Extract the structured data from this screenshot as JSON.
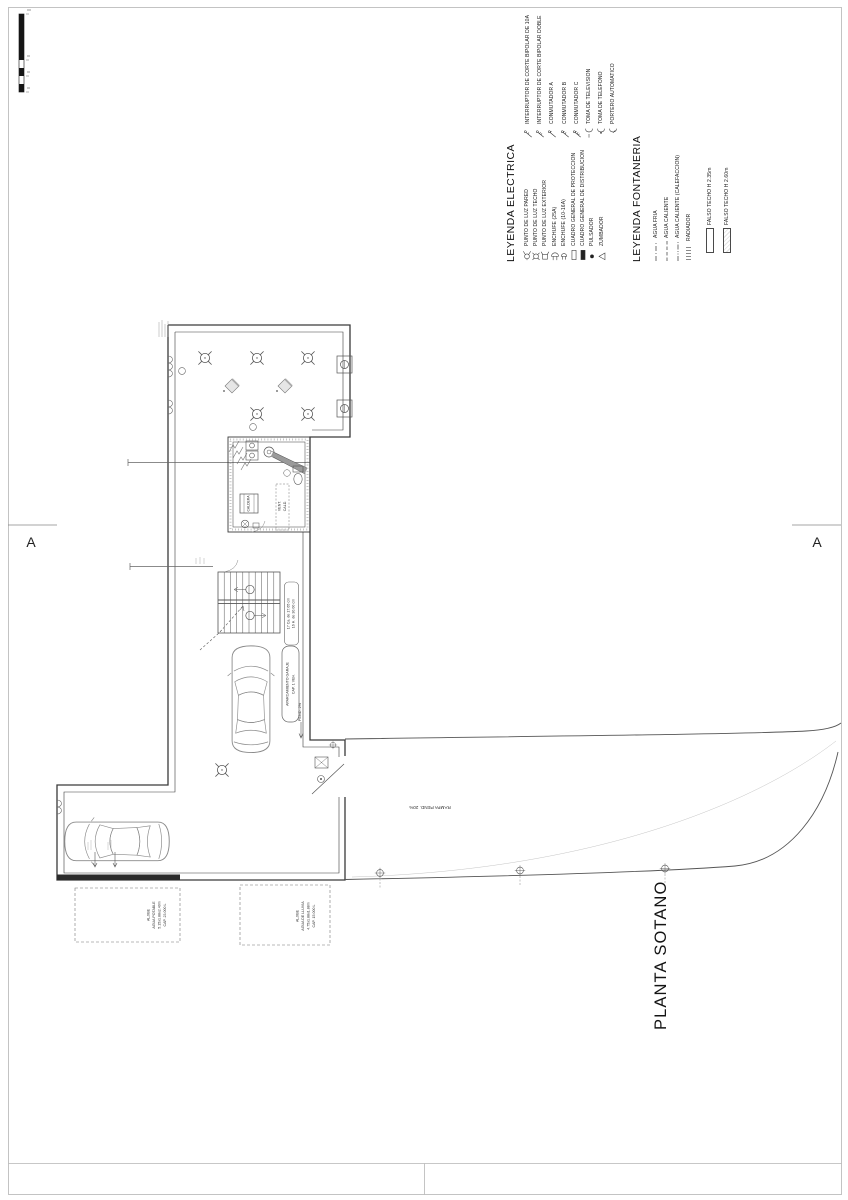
{
  "sheet": {
    "plan_title": "PLANTA SOTANO",
    "section_marker_left": "A",
    "section_marker_right": "A"
  },
  "legend_electrica": {
    "title": "LEYENDA ELECTRICA",
    "col1": [
      {
        "label": "PUNTO DE LUZ PARED"
      },
      {
        "label": "PUNTO DE LUZ TECHO"
      },
      {
        "label": "PUNTO DE LUZ EXTERIOR"
      },
      {
        "label": "ENCHUFE (25A)"
      },
      {
        "label": "ENCHUFE (10-16A)"
      },
      {
        "label": "CUADRO GENERAL DE PROTECCION"
      },
      {
        "label": "CUADRO GENERAL DE DISTRIBUCION"
      },
      {
        "label": "PULSADOR"
      },
      {
        "label": "ZUMBADOR"
      }
    ],
    "col2": [
      {
        "label": "INTERRUPTOR DE CORTE BIPOLAR DE 10A"
      },
      {
        "label": "INTERRUPTOR DE CORTE BIPOLAR DOBLE"
      },
      {
        "label": "CONMUTADOR A"
      },
      {
        "label": "CONMUTADOR B"
      },
      {
        "label": "CONMUTADOR C"
      },
      {
        "label": "TOMA DE TELEVISION"
      },
      {
        "label": "TOMA DE TELEFONO"
      },
      {
        "label": "PORTERO AUTOMATICO"
      }
    ]
  },
  "legend_fontaneria": {
    "title": "LEYENDA FONTANERIA",
    "lines": [
      {
        "label": "AGUA FRIA"
      },
      {
        "label": "AGUA CALIENTE"
      },
      {
        "label": "AGUA CALIENTE (CALEFACCION)"
      },
      {
        "label": "RADIADOR"
      }
    ],
    "falso_techo": [
      {
        "label": "FALSO TECHO H 2.35m"
      },
      {
        "label": "FALSO TECHO H 2.60m"
      }
    ]
  },
  "plan": {
    "stairs_note_1": "17 Ca. de 17.65 cm",
    "stairs_note_2": "16 H. de 30.00 cm",
    "garage_tag_1": "APARCAMIENTO GARAJE",
    "garage_tag_2": "CAP. 1 VEH.",
    "pend_label": "PEND. 2%",
    "ramp_label": "RAMPA PEND. 20%",
    "vent_label_1": "VENT.",
    "vent_label_2": "CALD.",
    "caldera_label": "CALDERA",
    "aljibe_potable": [
      "ALJIBE",
      "AGUA POTABLE",
      "5.15x1.88x2.40m",
      "CAP. 23.000 L"
    ],
    "aljibe_lluvia": [
      "ALJIBE",
      "AGUA DE LLUVIA",
      "4.75x1.88x1.88m",
      "CAP. 15.000 L"
    ]
  },
  "colors": {
    "line": "#444444",
    "frame": "#b5b5b5",
    "text": "#1c1c1c"
  }
}
